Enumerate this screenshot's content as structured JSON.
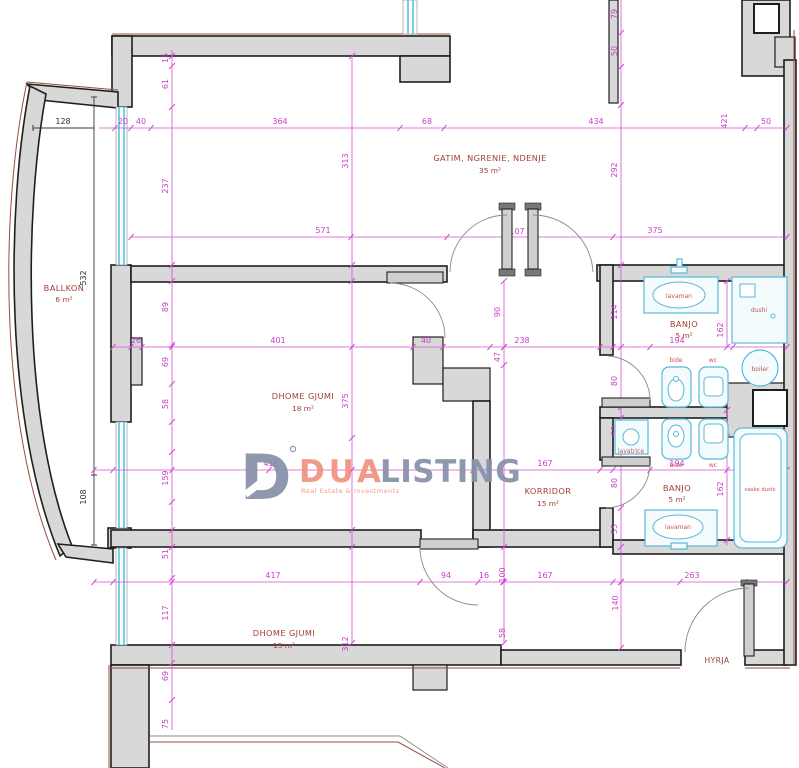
{
  "plan": {
    "rooms": [
      {
        "name": "BALLKON",
        "area": "6 m²"
      },
      {
        "name": "GATIM, NGRENIE, NDENJE",
        "area": "35 m²"
      },
      {
        "name": "DHOME GJUMI",
        "area": "18 m²"
      },
      {
        "name": "KORRIDOR",
        "area": "15 m²"
      },
      {
        "name": "BANJO",
        "area": "5 m²"
      },
      {
        "name": "BANJO",
        "area": "5 m²"
      },
      {
        "name": "DHOME GJUMI",
        "area": "15 m²"
      },
      {
        "name": "HYRJA",
        "area": ""
      }
    ],
    "fixtures": {
      "lavaman": "lavaman",
      "dushi": "dushi",
      "boiler": "boiler",
      "bide": "bide",
      "wc": "wc",
      "lavatrice": "lavatrice",
      "vaske_dushi": "vaske dushi"
    },
    "dims": {
      "top": [
        "128",
        "20",
        "40",
        "364",
        "68",
        "434",
        "421",
        "50"
      ],
      "topv": [
        "15",
        "61",
        "79",
        "50",
        "237",
        "313",
        "292"
      ],
      "mid": [
        "571",
        "107",
        "375"
      ],
      "black": [
        "532",
        "108"
      ],
      "r347": [
        "26",
        "401",
        "40",
        "238",
        "90",
        "47",
        "114",
        "194",
        "55",
        "162"
      ],
      "leftcol": [
        "89",
        "69",
        "58",
        "159",
        "51"
      ],
      "r470": [
        "416",
        "167",
        "194",
        "55",
        "375"
      ],
      "bath": [
        "80",
        "60",
        "80",
        "55",
        "162"
      ],
      "r582": [
        "417",
        "94",
        "16",
        "100",
        "167",
        "263"
      ],
      "botv": [
        "58",
        "140",
        "312"
      ],
      "botcol": [
        "117",
        "69",
        "75"
      ]
    }
  },
  "watermark": {
    "mark_letter": "D",
    "registered": "°",
    "brand_a": "DUA",
    "brand_b": "LISTING",
    "tagline": "Real Estate & Investments"
  },
  "colors": {
    "dimension": "#d24ad2",
    "wall_fill": "#d8d8d8",
    "room_label": "#a13f36",
    "window": "#4fc0dc",
    "fixture": "#57b9d9",
    "exterior_line": "#9a4a40",
    "logo_blue": "#8791a8",
    "logo_salmon": "#f2937f"
  }
}
